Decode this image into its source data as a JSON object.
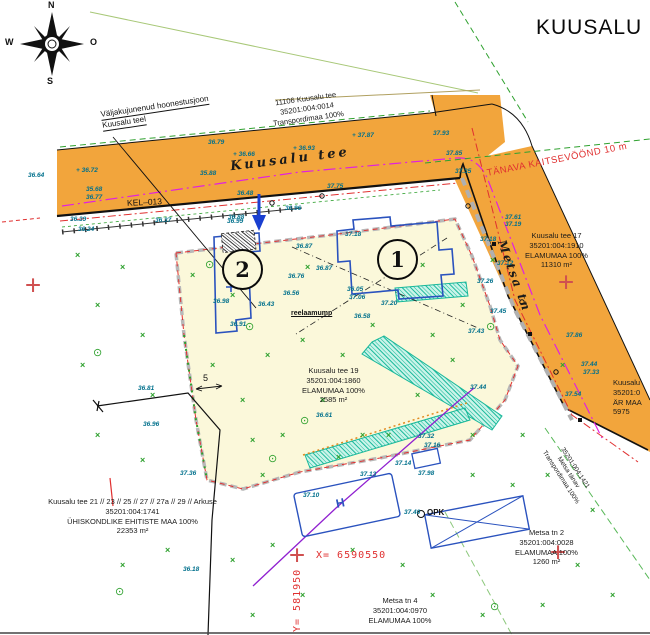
{
  "title": "KUUSALU",
  "compass": {
    "n": "N",
    "e": "O",
    "s": "S",
    "w": "W"
  },
  "street_labels": {
    "kuusalu_tee": "Kuusalu tee",
    "metsa_tn": "Metsa tn"
  },
  "annotations": {
    "building_line_label": "Väljakujunenud hoonestusjoon",
    "building_line_sub": "Kuusalu teel",
    "kel_label": "KEL–013",
    "protection_zone_label": "TÄNAVA KAITSEVÖÖND 10 m",
    "coord_x_label": "X=  6590550",
    "coord_y_label": "Y=  581950",
    "opk_label": "OPK",
    "house_label_h": "H",
    "small_underlined_note": "reelaamump",
    "dimension_5": "5"
  },
  "buildings": {
    "circle1": "1",
    "circle2": "2"
  },
  "parcels": {
    "p11106": {
      "line1": "11106 Kuusalu tee",
      "line2": "35201:004:0014",
      "line3": "Transpordimaa 100%"
    },
    "k17": {
      "line1": "Kuusalu tee 17",
      "line2": "35201:004:1910",
      "line3": "ELAMUMAA 100%",
      "line4": "11310 m²"
    },
    "k19": {
      "line1": "Kuusalu tee 19",
      "line2": "35201:004:1860",
      "line3": "ELAMUMAA 100%",
      "line4": "2585 m²"
    },
    "k21": {
      "line1": "Kuusalu tee 21 // 23 // 25 // 27 // 27a // 29 // Arkuse",
      "line2": "35201:004:1741",
      "line3": "ÜHISKONDLIKE EHITISTE MAA 100%",
      "line4": "22353 m²"
    },
    "m2": {
      "line1": "Metsa tn 2",
      "line2": "35201:004:0028",
      "line3": "ELAMUMAA 100%",
      "line4": "1260 m²"
    },
    "m4": {
      "line1": "Metsa tn 4",
      "line2": "35201:004:0970",
      "line3": "ELAMUMAA 100%"
    },
    "right_edge": {
      "line1": "Kuusalu",
      "line2": "35201:0",
      "line3": "ÄR MAA",
      "line4": "5975"
    },
    "metsa_road": {
      "line1": "35201:004:1421",
      "line2": "Metsa tänav",
      "line3": "Transpordimaa 100%"
    }
  },
  "icons": {
    "bush": "×",
    "tree": "⊙",
    "grid_cross": "+"
  },
  "colors": {
    "road_fill": "#F2A53C",
    "parcel_fill": "#FBF8DA",
    "elevation_text": "#00708C",
    "vegetation_green": "#2FA12F",
    "boundary_red": "#E03030",
    "utility_magenta": "#E020E0",
    "utility_purple": "#9020D0",
    "building_blue": "#2A52BE",
    "teal_hatch": "#18B89A",
    "grid_cross_red": "#D05050"
  },
  "spot_elevations": [
    {
      "x": 208,
      "y": 139,
      "v": "36.79"
    },
    {
      "x": 233,
      "y": 151,
      "v": "+ 36.66"
    },
    {
      "x": 293,
      "y": 145,
      "v": "+ 36.93"
    },
    {
      "x": 352,
      "y": 132,
      "v": "+ 37.87"
    },
    {
      "x": 28,
      "y": 172,
      "v": "36.64"
    },
    {
      "x": 76,
      "y": 167,
      "v": "+ 36.72"
    },
    {
      "x": 86,
      "y": 186,
      "v": "35.68"
    },
    {
      "x": 86,
      "y": 194,
      "v": "36.77"
    },
    {
      "x": 200,
      "y": 170,
      "v": "35.88"
    },
    {
      "x": 70,
      "y": 216,
      "v": "36.39"
    },
    {
      "x": 78,
      "y": 226,
      "v": "36.24"
    },
    {
      "x": 155,
      "y": 217,
      "v": "36.37"
    },
    {
      "x": 228,
      "y": 214,
      "v": "36.88"
    },
    {
      "x": 237,
      "y": 190,
      "v": "36.48"
    },
    {
      "x": 227,
      "y": 218,
      "v": "36.99"
    },
    {
      "x": 285,
      "y": 205,
      "v": "36.96"
    },
    {
      "x": 327,
      "y": 183,
      "v": "37.75"
    },
    {
      "x": 296,
      "y": 243,
      "v": "36.87"
    },
    {
      "x": 316,
      "y": 265,
      "v": "36.87"
    },
    {
      "x": 288,
      "y": 273,
      "v": "36.76"
    },
    {
      "x": 283,
      "y": 290,
      "v": "36.56"
    },
    {
      "x": 345,
      "y": 231,
      "v": "37.18"
    },
    {
      "x": 347,
      "y": 286,
      "v": "36.05"
    },
    {
      "x": 349,
      "y": 294,
      "v": "37.06"
    },
    {
      "x": 381,
      "y": 300,
      "v": "37.20"
    },
    {
      "x": 354,
      "y": 313,
      "v": "36.58"
    },
    {
      "x": 258,
      "y": 301,
      "v": "36.43"
    },
    {
      "x": 230,
      "y": 321,
      "v": "36.91"
    },
    {
      "x": 213,
      "y": 298,
      "v": "36.98"
    },
    {
      "x": 316,
      "y": 412,
      "v": "36.61"
    },
    {
      "x": 138,
      "y": 385,
      "v": "36.81"
    },
    {
      "x": 143,
      "y": 421,
      "v": "36.96"
    },
    {
      "x": 180,
      "y": 470,
      "v": "37.36"
    },
    {
      "x": 183,
      "y": 566,
      "v": "36.18"
    },
    {
      "x": 418,
      "y": 433,
      "v": "37.32"
    },
    {
      "x": 424,
      "y": 442,
      "v": "37.16"
    },
    {
      "x": 395,
      "y": 460,
      "v": "37.14"
    },
    {
      "x": 360,
      "y": 471,
      "v": "37.13"
    },
    {
      "x": 418,
      "y": 470,
      "v": "37.98"
    },
    {
      "x": 303,
      "y": 492,
      "v": "37.10"
    },
    {
      "x": 404,
      "y": 509,
      "v": "37.40"
    },
    {
      "x": 480,
      "y": 236,
      "v": "37.18"
    },
    {
      "x": 497,
      "y": 260,
      "v": "37.12"
    },
    {
      "x": 477,
      "y": 278,
      "v": "37.26"
    },
    {
      "x": 490,
      "y": 308,
      "v": "37.45"
    },
    {
      "x": 468,
      "y": 328,
      "v": "37.43"
    },
    {
      "x": 566,
      "y": 332,
      "v": "37.86"
    },
    {
      "x": 581,
      "y": 361,
      "v": "37.44"
    },
    {
      "x": 583,
      "y": 369,
      "v": "37.33"
    },
    {
      "x": 565,
      "y": 391,
      "v": "37.54"
    },
    {
      "x": 433,
      "y": 130,
      "v": "37.93"
    },
    {
      "x": 446,
      "y": 150,
      "v": "37.85"
    },
    {
      "x": 455,
      "y": 168,
      "v": "37.35"
    },
    {
      "x": 505,
      "y": 214,
      "v": "37.61"
    },
    {
      "x": 505,
      "y": 221,
      "v": "37.19"
    },
    {
      "x": 470,
      "y": 384,
      "v": "37.44"
    }
  ],
  "vegetation": {
    "bushes": [
      [
        75,
        250
      ],
      [
        120,
        262
      ],
      [
        95,
        300
      ],
      [
        140,
        330
      ],
      [
        80,
        360
      ],
      [
        150,
        390
      ],
      [
        95,
        430
      ],
      [
        140,
        455
      ],
      [
        165,
        545
      ],
      [
        120,
        560
      ],
      [
        230,
        555
      ],
      [
        270,
        540
      ],
      [
        350,
        545
      ],
      [
        300,
        590
      ],
      [
        250,
        610
      ],
      [
        400,
        560
      ],
      [
        470,
        470
      ],
      [
        510,
        480
      ],
      [
        545,
        470
      ],
      [
        590,
        505
      ],
      [
        520,
        430
      ],
      [
        470,
        430
      ],
      [
        300,
        335
      ],
      [
        265,
        350
      ],
      [
        240,
        395
      ],
      [
        280,
        430
      ],
      [
        320,
        395
      ],
      [
        260,
        470
      ],
      [
        340,
        350
      ],
      [
        430,
        330
      ],
      [
        450,
        355
      ],
      [
        415,
        390
      ],
      [
        360,
        430
      ],
      [
        490,
        255
      ],
      [
        460,
        300
      ],
      [
        560,
        360
      ],
      [
        230,
        290
      ],
      [
        190,
        270
      ],
      [
        210,
        360
      ],
      [
        250,
        435
      ],
      [
        305,
        262
      ],
      [
        370,
        320
      ],
      [
        420,
        260
      ],
      [
        575,
        560
      ],
      [
        610,
        590
      ],
      [
        540,
        600
      ],
      [
        480,
        610
      ],
      [
        430,
        590
      ],
      [
        336,
        452
      ],
      [
        386,
        430
      ]
    ],
    "trees": [
      [
        93,
        346
      ],
      [
        300,
        414
      ],
      [
        268,
        452
      ],
      [
        490,
        600
      ],
      [
        115,
        585
      ],
      [
        205,
        258
      ],
      [
        245,
        320
      ],
      [
        486,
        320
      ]
    ]
  },
  "grid_crosses": [
    [
      33,
      287
    ],
    [
      566,
      284
    ],
    [
      297,
      557
    ],
    [
      558,
      554
    ]
  ]
}
